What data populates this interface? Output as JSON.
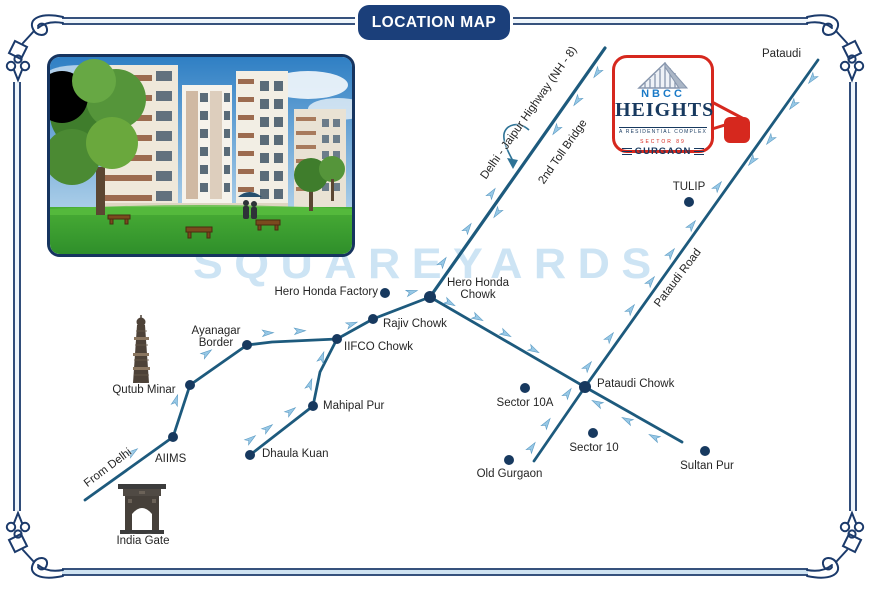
{
  "title": "LOCATION MAP",
  "watermark": "SQUAREYARDS",
  "logo": {
    "brand": "NBCC",
    "name": "HEIGHTS",
    "tagline": "A RESIDENTIAL COMPLEX",
    "sector": "SECTOR 89",
    "city": "GURGAON"
  },
  "colors": {
    "frame": "#1b3a6b",
    "road": "#1d5a7d",
    "dot": "#17395f",
    "arrow": "#97c8e6",
    "arrow_edge": "#5d9cc4",
    "badge_bg": "#1b3f7a",
    "watermark": "#cde4f4",
    "logo_red": "#d6281e",
    "logo_navy": "#17395f",
    "logo_blue": "#1a7ac7"
  },
  "map": {
    "roads": [
      {
        "name": "nh8-highway",
        "width": 3.2,
        "points": [
          [
            605,
            48
          ],
          [
            430,
            297
          ]
        ]
      },
      {
        "name": "hero-honda-to-sultanpur-road",
        "width": 2.8,
        "points": [
          [
            430,
            297
          ],
          [
            585,
            387
          ],
          [
            682,
            442
          ]
        ]
      },
      {
        "name": "pataudi-road",
        "width": 2.8,
        "points": [
          [
            534,
            461
          ],
          [
            585,
            387
          ],
          [
            818,
            60
          ]
        ]
      },
      {
        "name": "rajiv-chowk-road",
        "width": 2.8,
        "points": [
          [
            430,
            297
          ],
          [
            373,
            319
          ],
          [
            337,
            339
          ]
        ]
      },
      {
        "name": "ayanagar-road",
        "width": 2.8,
        "points": [
          [
            337,
            339
          ],
          [
            272,
            342
          ],
          [
            247,
            345
          ]
        ]
      },
      {
        "name": "mahipalpur-road",
        "width": 2.8,
        "points": [
          [
            337,
            339
          ],
          [
            320,
            372
          ],
          [
            313,
            406
          ],
          [
            250,
            455
          ]
        ]
      },
      {
        "name": "delhi-road",
        "width": 2.8,
        "points": [
          [
            85,
            500
          ],
          [
            173,
            437
          ],
          [
            190,
            385
          ],
          [
            247,
            345
          ]
        ]
      }
    ],
    "places": [
      {
        "id": "hero-honda-factory",
        "label": "Hero Honda Factory",
        "dot": [
          385,
          293
        ],
        "r": 5,
        "text": [
          250,
          286,
          128,
          "right"
        ]
      },
      {
        "id": "hero-honda-chowk",
        "label": "Hero Honda Chowk",
        "dot": [
          430,
          297
        ],
        "r": 6,
        "text": [
          441,
          277,
          74,
          "center"
        ]
      },
      {
        "id": "rajiv-chowk",
        "label": "Rajiv Chowk",
        "dot": [
          373,
          319
        ],
        "r": 5,
        "text": [
          383,
          318,
          82,
          "left"
        ]
      },
      {
        "id": "iifco-chowk",
        "label": "IIFCO Chowk",
        "dot": [
          337,
          339
        ],
        "r": 5,
        "text": [
          344,
          341,
          92,
          "left"
        ]
      },
      {
        "id": "ayanagar-border",
        "label": "Ayanagar Border",
        "dot": [
          247,
          345
        ],
        "r": 5,
        "text": [
          182,
          325,
          68,
          "center"
        ]
      },
      {
        "id": "qutub-junction",
        "label": "",
        "dot": [
          190,
          385
        ],
        "r": 5,
        "text": null
      },
      {
        "id": "aiims",
        "label": "AIIMS",
        "dot": [
          173,
          437
        ],
        "r": 5,
        "text": [
          155,
          453,
          60,
          "left"
        ]
      },
      {
        "id": "mahipal-pur",
        "label": "Mahipal Pur",
        "dot": [
          313,
          406
        ],
        "r": 5,
        "text": [
          323,
          400,
          90,
          "left"
        ]
      },
      {
        "id": "dhaula-kuan",
        "label": "Dhaula Kuan",
        "dot": [
          250,
          455
        ],
        "r": 5,
        "text": [
          262,
          448,
          95,
          "left"
        ]
      },
      {
        "id": "tulip",
        "label": "TULIP",
        "dot": [
          689,
          202
        ],
        "r": 5,
        "text": [
          664,
          181,
          50,
          "center"
        ]
      },
      {
        "id": "pataudi-chowk",
        "label": "Pataudi Chowk",
        "dot": [
          585,
          387
        ],
        "r": 6,
        "text": [
          597,
          378,
          105,
          "left"
        ]
      },
      {
        "id": "sector-10a",
        "label": "Sector 10A",
        "dot": [
          525,
          388
        ],
        "r": 5,
        "text": [
          491,
          397,
          68,
          "center"
        ]
      },
      {
        "id": "sector-10",
        "label": "Sector 10",
        "dot": [
          593,
          433
        ],
        "r": 5,
        "text": [
          564,
          442,
          60,
          "center"
        ]
      },
      {
        "id": "old-gurgaon",
        "label": "Old Gurgaon",
        "dot": [
          509,
          460
        ],
        "r": 5,
        "text": [
          472,
          468,
          75,
          "center"
        ]
      },
      {
        "id": "sultan-pur",
        "label": "Sultan Pur",
        "dot": [
          705,
          451
        ],
        "r": 5,
        "text": [
          676,
          460,
          62,
          "center"
        ]
      },
      {
        "id": "pataudi-town",
        "label": "Pataudi",
        "dot": null,
        "text": [
          762,
          48,
          55,
          "left"
        ]
      }
    ],
    "road_labels": [
      {
        "id": "nh8-label",
        "label": "Delhi - Jaipur Highway (NH - 8)",
        "x": 529,
        "y": 113,
        "angle": -55
      },
      {
        "id": "toll-bridge-label",
        "label": "2nd Toll Bridge",
        "x": 563,
        "y": 152,
        "angle": -55
      },
      {
        "id": "pataudi-road-label",
        "label": "Pataudi Road",
        "x": 678,
        "y": 278,
        "angle": -53
      },
      {
        "id": "from-delhi-label",
        "label": "From Delhi",
        "x": 108,
        "y": 468,
        "angle": -37
      }
    ],
    "landmarks": [
      {
        "id": "qutub-minar",
        "label": "Qutub Minar",
        "text": [
          108,
          384,
          72,
          "center"
        ]
      },
      {
        "id": "india-gate",
        "label": "India Gate",
        "text": [
          112,
          535,
          62,
          "center"
        ]
      }
    ],
    "arrows": [
      [
        443,
        262,
        -55
      ],
      [
        468,
        228,
        -55
      ],
      [
        492,
        193,
        -55
      ],
      [
        597,
        73,
        125
      ],
      [
        577,
        101,
        125
      ],
      [
        556,
        130,
        125
      ],
      [
        497,
        213,
        125
      ],
      [
        450,
        303,
        28
      ],
      [
        478,
        318,
        28
      ],
      [
        506,
        334,
        28
      ],
      [
        534,
        350,
        28
      ],
      [
        588,
        366,
        -52
      ],
      [
        610,
        337,
        -52
      ],
      [
        631,
        309,
        -52
      ],
      [
        651,
        281,
        -52
      ],
      [
        671,
        253,
        -52
      ],
      [
        692,
        225,
        -52
      ],
      [
        718,
        186,
        -52
      ],
      [
        812,
        79,
        128
      ],
      [
        793,
        105,
        128
      ],
      [
        770,
        140,
        128
      ],
      [
        752,
        161,
        128
      ],
      [
        532,
        447,
        -55
      ],
      [
        547,
        423,
        -55
      ],
      [
        568,
        393,
        -55
      ],
      [
        597,
        403,
        207
      ],
      [
        627,
        420,
        207
      ],
      [
        654,
        437,
        207
      ],
      [
        268,
        333,
        -3
      ],
      [
        300,
        331,
        -3
      ],
      [
        352,
        324,
        -20
      ],
      [
        412,
        292,
        -15
      ],
      [
        322,
        357,
        -70
      ],
      [
        310,
        384,
        -70
      ],
      [
        291,
        411,
        -37
      ],
      [
        268,
        428,
        -37
      ],
      [
        251,
        439,
        -37
      ],
      [
        133,
        452,
        -36
      ],
      [
        176,
        400,
        -72
      ],
      [
        207,
        353,
        -35
      ]
    ]
  }
}
